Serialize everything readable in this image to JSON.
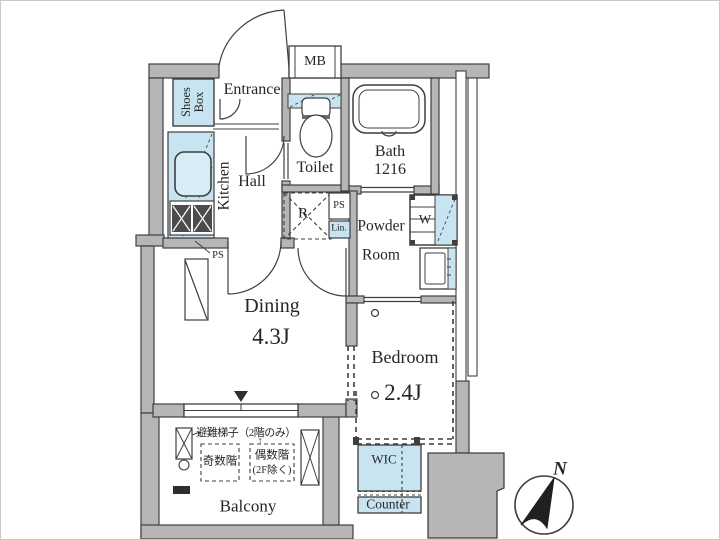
{
  "plan_title": "apartment-floor-plan",
  "colors": {
    "wall_fill": "#b6b6b6",
    "fixture_blue": "#c9e4f1",
    "line": "#3f3f3f",
    "dark_fill": "#2e2e2e",
    "background": "#ffffff"
  },
  "rooms": {
    "entrance": {
      "label": "Entrance"
    },
    "shoes_box": {
      "label": "Shoes Box"
    },
    "meter_box": {
      "label": "MB"
    },
    "toilet": {
      "label": "Toilet"
    },
    "bath": {
      "label": "Bath",
      "size": "1216"
    },
    "kitchen": {
      "label": "Kitchen"
    },
    "hall": {
      "label": "Hall"
    },
    "refrigerator_space": {
      "label": "R"
    },
    "pipe_space_hall": {
      "label": "PS"
    },
    "linen": {
      "label": "Lin."
    },
    "powder_room": {
      "line1": "Powder",
      "line2": "Room"
    },
    "washer": {
      "label": "W"
    },
    "pipe_space_dining": {
      "label": "PS"
    },
    "dining": {
      "label": "Dining",
      "size": "4.3J"
    },
    "bedroom": {
      "label": "Bedroom",
      "size": "2.4J"
    },
    "wic": {
      "label": "WIC"
    },
    "counter": {
      "label": "Counter"
    },
    "balcony": {
      "label": "Balcony"
    }
  },
  "balcony_annotations": {
    "evacuation_ladder": "避難梯子（2階のみ）",
    "odd_floors": "奇数階",
    "even_floors": "偶数階",
    "even_floors_note": "(2F除く)",
    "up_arrow": "↑"
  },
  "compass": {
    "north_label": "N"
  }
}
